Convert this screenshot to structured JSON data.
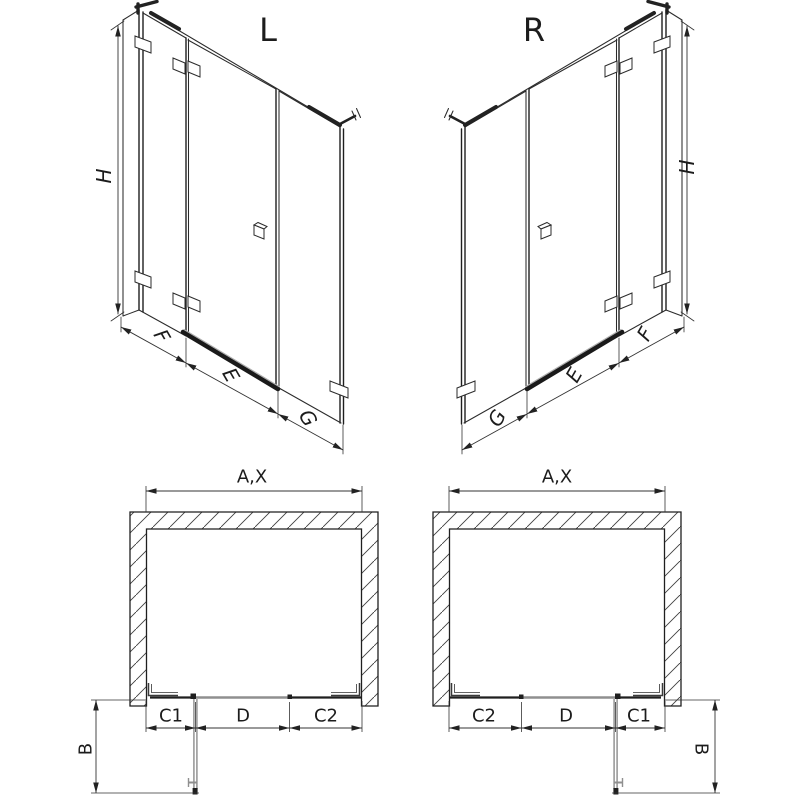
{
  "colors": {
    "ink": "#1c1c1c",
    "gray": "#8f8f8f",
    "bg": "#ffffff"
  },
  "views": {
    "iso_l": {
      "title": "L",
      "height_label": "H",
      "width_labels": [
        "F",
        "E",
        "G"
      ]
    },
    "iso_r": {
      "title": "R",
      "height_label": "H",
      "width_labels": [
        "G",
        "E",
        "F"
      ]
    },
    "plan_l": {
      "width_label": "A,X",
      "segment_labels": [
        "C1",
        "D",
        "C2"
      ],
      "depth_label": "B"
    },
    "plan_r": {
      "width_label": "A,X",
      "segment_labels": [
        "C2",
        "D",
        "C1"
      ],
      "depth_label": "B"
    }
  }
}
